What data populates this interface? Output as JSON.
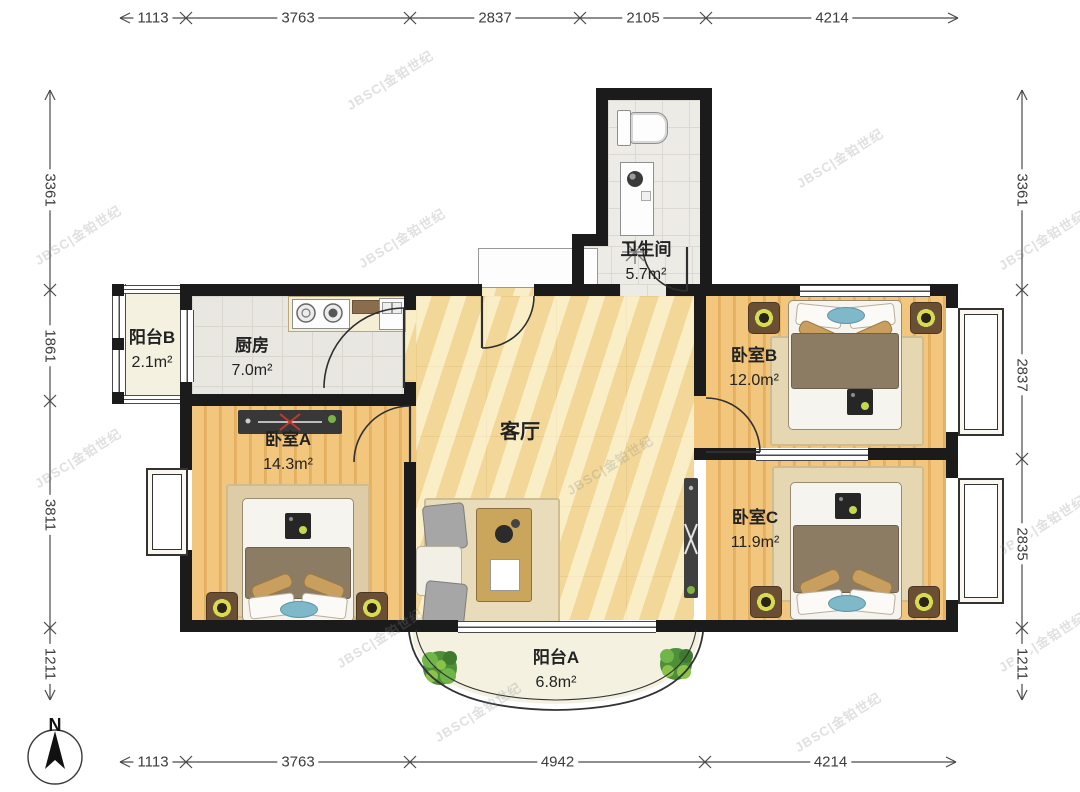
{
  "plan": {
    "compass_label": "N",
    "watermark_text": "JBSC|金铂世纪",
    "rooms": [
      {
        "name": "阳台B",
        "area": "2.1m²"
      },
      {
        "name": "厨房",
        "area": "7.0m²"
      },
      {
        "name": "卫生间",
        "area": "5.7m²"
      },
      {
        "name": "客厅",
        "area": ""
      },
      {
        "name": "卧室A",
        "area": "14.3m²"
      },
      {
        "name": "卧室B",
        "area": "12.0m²"
      },
      {
        "name": "卧室C",
        "area": "11.9m²"
      },
      {
        "name": "阳台A",
        "area": "6.8m²"
      }
    ],
    "dimensions": {
      "top": [
        "1113",
        "3763",
        "2837",
        "2105",
        "4214"
      ],
      "bottom": [
        "1113",
        "3763",
        "4942",
        "4214"
      ],
      "left": [
        "3361",
        "1861",
        "3811",
        "1211"
      ],
      "right": [
        "3361",
        "2837",
        "2835",
        "1211"
      ]
    }
  }
}
